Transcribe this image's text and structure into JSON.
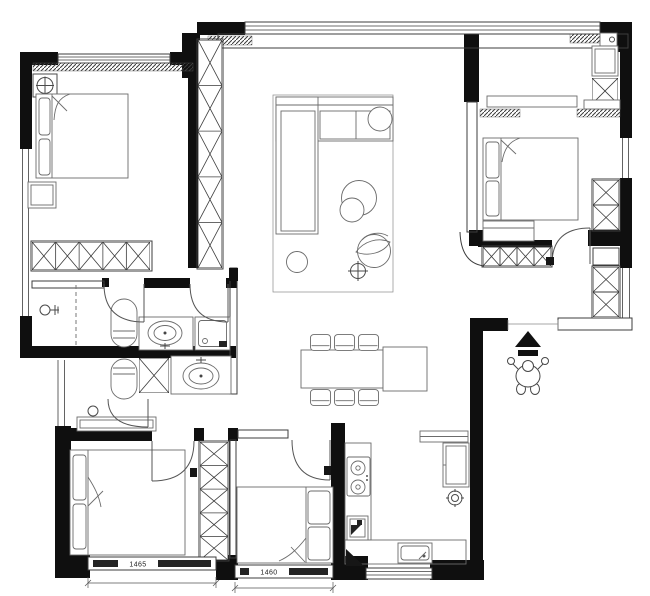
{
  "meta": {
    "type": "architectural-floor-plan",
    "canvas_width": 650,
    "canvas_height": 596
  },
  "colors": {
    "background": "#ffffff",
    "wall_fill": "#0f0f0f",
    "structure_line": "#3c3c3c",
    "furniture_line": "#6b6b6b",
    "dimension_text": "#1a1a1a"
  },
  "labels": {
    "window_left_dimension": "1465",
    "window_middle_dimension": "1460"
  },
  "rooms": [
    {
      "id": "bedroom-top-left",
      "fixtures": [
        "double-bed",
        "pillows",
        "nightstand",
        "wardrobe-x-row",
        "ceiling-light-symbol",
        "window-top",
        "window-left"
      ]
    },
    {
      "id": "living-room",
      "fixtures": [
        "l-shaped-sofa",
        "round-side-table",
        "rug",
        "pouf-circles",
        "plant",
        "ceiling-symbol",
        "bay-window"
      ]
    },
    {
      "id": "dining-area",
      "fixtures": [
        "dining-table",
        "six-chairs",
        "sideboard"
      ]
    },
    {
      "id": "bedroom-top-right",
      "fixtures": [
        "double-bed",
        "bench",
        "headboard-shelf",
        "wardrobe-x-row",
        "closet-column",
        "curtain-hatches",
        "window-right"
      ]
    },
    {
      "id": "bathroom-upper",
      "fixtures": [
        "shower-head",
        "dashed-shower-screen",
        "toilet",
        "vanity-sink",
        "washing-machine"
      ]
    },
    {
      "id": "bathroom-lower",
      "fixtures": [
        "toilet",
        "storage-x-box",
        "vanity-sink",
        "shower-head",
        "console-table"
      ]
    },
    {
      "id": "bedroom-bottom-left",
      "fixtures": [
        "double-bed",
        "wardrobe-x-column",
        "window-1465"
      ]
    },
    {
      "id": "bedroom-bottom-middle",
      "fixtures": [
        "double-bed",
        "window-1460"
      ]
    },
    {
      "id": "kitchen",
      "fixtures": [
        "gas-hob",
        "kitchen-sink",
        "fridge",
        "shelf",
        "floor-drain",
        "small-appliance",
        "kitchen-window"
      ]
    },
    {
      "id": "entry-corridor",
      "fixtures": [
        "entry-arrow",
        "person-figure",
        "shoe-cabinet-x-column"
      ]
    }
  ]
}
